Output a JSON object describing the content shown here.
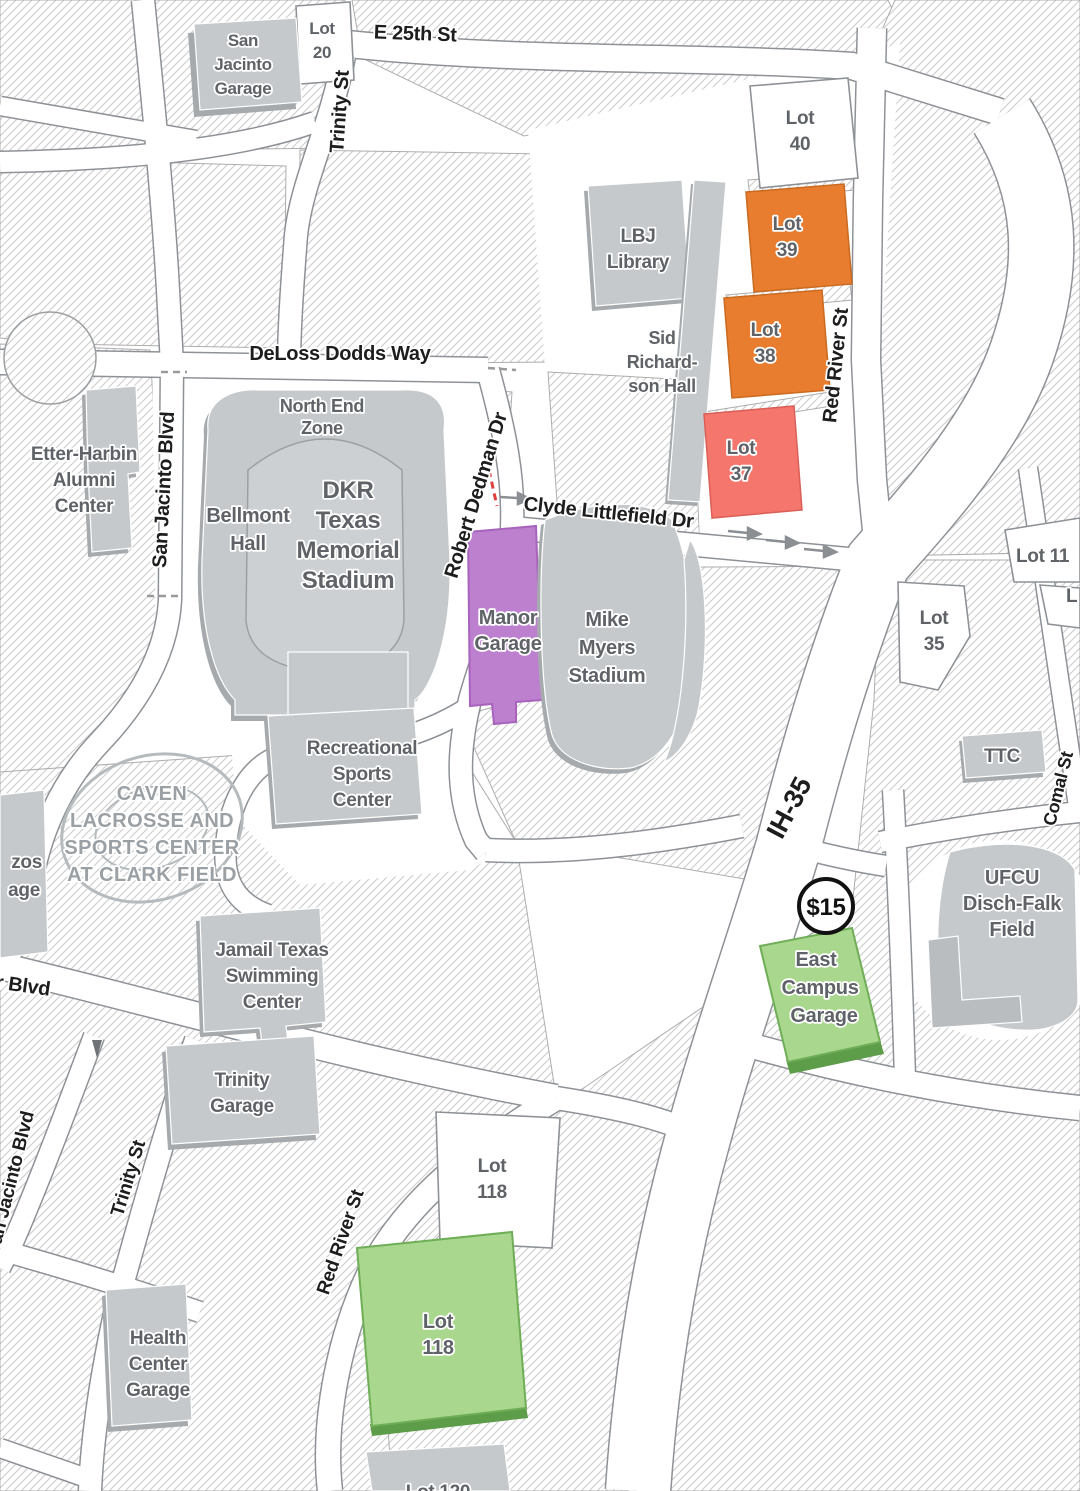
{
  "title": "UT Austin stadium-area parking map",
  "labels": {
    "streets": {
      "e25th": "E 25th St",
      "trinity_north": "Trinity St",
      "trinity_south": "Trinity St",
      "deloss_dodds": "DeLoss Dodds Way",
      "san_jacinto_mid": "San Jacinto Blvd",
      "san_jacinto_south": "San Jacinto Blvd",
      "robert_dedman": "Robert Dedman Dr",
      "clyde_littlefield": "Clyde Littlefield Dr",
      "red_river_north": "Red River St",
      "red_river_south": "Red River St",
      "ih35": "IH-35",
      "comal": "Comal St",
      "partial_blvd": "r Blvd"
    },
    "buildings": {
      "san_jacinto_garage": [
        "San",
        "Jacinto",
        "Garage"
      ],
      "lbj_library": [
        "LBJ",
        "Library"
      ],
      "sid_richardson": [
        "Sid",
        "Richard-",
        "son Hall"
      ],
      "etter_harbin": [
        "Etter-Harbin",
        "Alumni",
        "Center"
      ],
      "north_end_zone": [
        "North End",
        "Zone"
      ],
      "dkr": [
        "DKR",
        "Texas",
        "Memorial",
        "Stadium"
      ],
      "bellmont": [
        "Bellmont",
        "Hall"
      ],
      "rec_sports": [
        "Recreational",
        "Sports",
        "Center"
      ],
      "manor_garage": [
        "Manor",
        "Garage"
      ],
      "mike_myers": [
        "Mike",
        "Myers",
        "Stadium"
      ],
      "caven": [
        "CAVEN",
        "LACROSSE AND",
        "SPORTS CENTER",
        "AT CLARK FIELD"
      ],
      "brazos_partial": [
        "zos",
        "age"
      ],
      "jamail": [
        "Jamail Texas",
        "Swimming",
        "Center"
      ],
      "trinity_garage": [
        "Trinity",
        "Garage"
      ],
      "east_campus_garage": [
        "East",
        "Campus",
        "Garage"
      ],
      "ufcu": [
        "UFCU",
        "Disch-Falk",
        "Field"
      ],
      "ttc": [
        "TTC"
      ],
      "health_center_garage": [
        "Health",
        "Center",
        "Garage"
      ]
    },
    "lots": {
      "lot20": [
        "Lot",
        "20"
      ],
      "lot40": [
        "Lot",
        "40"
      ],
      "lot39": [
        "Lot",
        "39"
      ],
      "lot38": [
        "Lot",
        "38"
      ],
      "lot37": [
        "Lot",
        "37"
      ],
      "lot35": [
        "Lot",
        "35"
      ],
      "lot118_white": [
        "Lot",
        "118"
      ],
      "lot118_green": [
        "Lot",
        "118"
      ]
    },
    "partial_lots": {
      "lot11": "Lot 11",
      "l_only": "L",
      "lot120": "Lot 120"
    },
    "price_badge": "$15"
  },
  "colors": {
    "lot_orange": "#E87C2F",
    "lot_salmon": "#F5766D",
    "garage_purple": "#BC80CF",
    "lot_green": "#A9D78D",
    "green_shadow": "#5D9C49",
    "building_gray": "#C6C9CB",
    "building_shadow": "#A6AAAD",
    "hatch_line": "#CDCDCD",
    "road_casing": "#8E9296",
    "label_gray": "#5F6367",
    "street_black": "#1D1D1D",
    "dashed_red": "#E03F3F"
  }
}
